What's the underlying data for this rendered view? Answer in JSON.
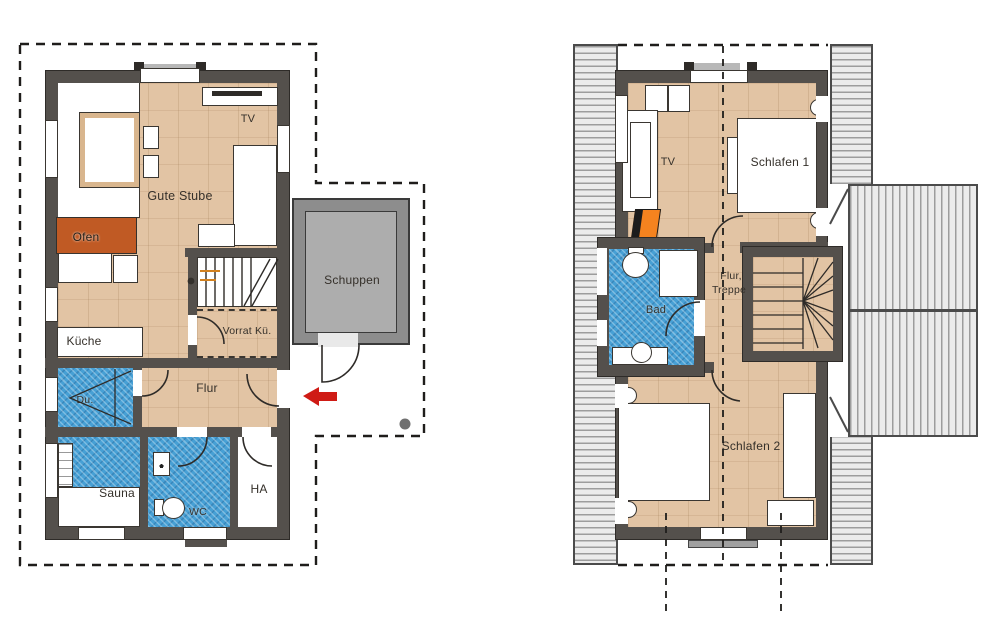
{
  "plans": {
    "ground_floor": {
      "labels": {
        "gute_stube": "Gute Stube",
        "tv": "TV",
        "ofen": "Ofen",
        "kueche": "Küche",
        "dusche": "Du.",
        "sauna": "Sauna",
        "wc": "WC",
        "ha": "HA",
        "flur": "Flur",
        "vorrat": "Vorrat Kü.",
        "schuppen": "Schuppen"
      }
    },
    "upper_floor": {
      "labels": {
        "tv": "TV",
        "schlafen1": "Schlafen 1",
        "flur_line1": "Flur,",
        "flur_line2": "Treppe",
        "bad": "Bad",
        "schlafen2": "Schlafen 2"
      }
    }
  },
  "colors": {
    "wall": "#54504c",
    "wood_floor": "#e2c4a4",
    "tile_blue": "#47a0d5",
    "oven_orange": "#c05a24",
    "chimney_orange": "#f5831f",
    "entry_arrow_red": "#cf1b15",
    "shed_wall_gray": "#8d8d8d",
    "shed_floor_gray": "#adadad",
    "roof_hatch_gray": "#ebebeb"
  }
}
